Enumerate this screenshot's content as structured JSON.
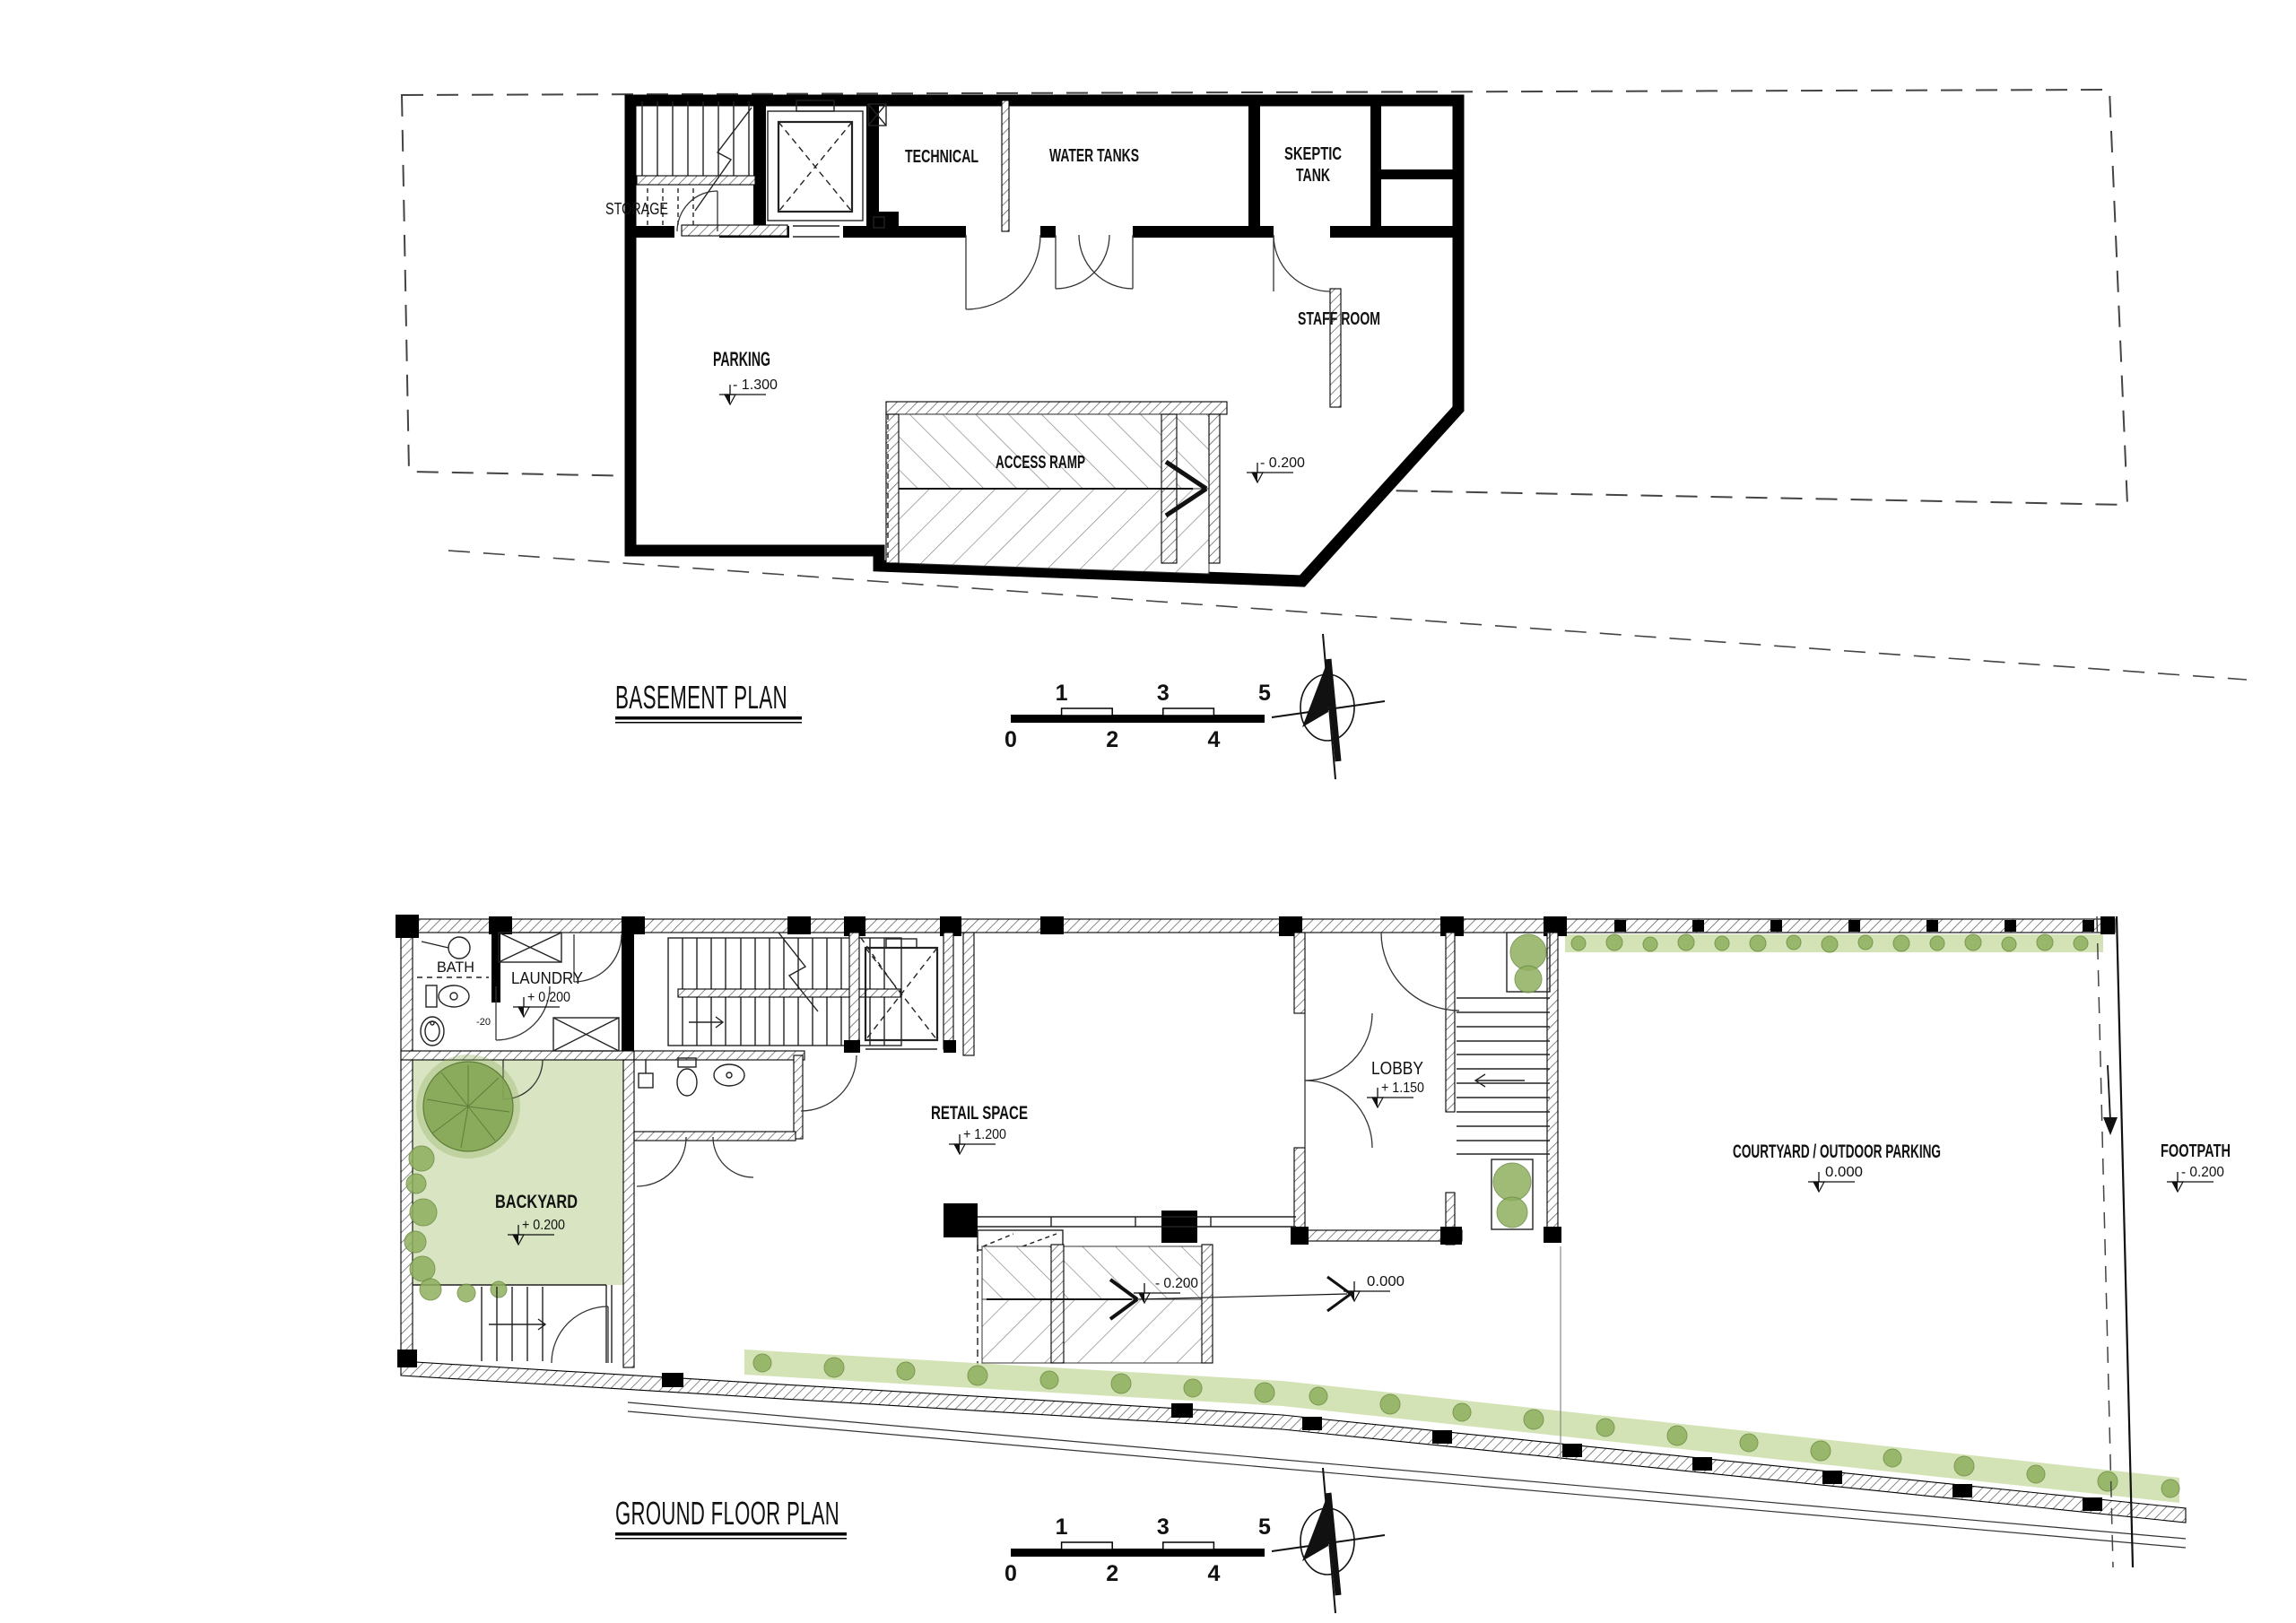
{
  "basement": {
    "title": "BASEMENT PLAN",
    "rooms": {
      "storage": "STORAGE",
      "technical": "TECHNICAL",
      "water_tanks": "WATER TANKS",
      "skeptic_tank_line1": "SKEPTIC",
      "skeptic_tank_line2": "TANK",
      "staff_room": "STAFF ROOM",
      "parking": "PARKING",
      "parking_level": "- 1.300",
      "access_ramp": "ACCESS RAMP",
      "access_ramp_level": "- 0.200"
    }
  },
  "ground": {
    "title": "GROUND FLOOR PLAN",
    "rooms": {
      "bath": "BATH",
      "laundry": "LAUNDRY",
      "laundry_level": "+ 0.200",
      "door_dimension": "-20",
      "backyard": "BACKYARD",
      "backyard_level": "+ 0.200",
      "retail": "RETAIL SPACE",
      "retail_level": "+ 1.200",
      "lobby": "LOBBY",
      "lobby_level": "+ 1.150",
      "courtyard": "COURTYARD / OUTDOOR PARKING",
      "courtyard_level": "0.000",
      "driveway_level_low": "- 0.200",
      "driveway_level_high": "0.000",
      "footpath": "FOOTPATH",
      "footpath_level": "- 0.200"
    }
  },
  "scale_bar": {
    "top_labels": [
      "1",
      "3",
      "5"
    ],
    "bottom_labels": [
      "0",
      "2",
      "4"
    ]
  },
  "colors": {
    "wall": "#000000",
    "hatch_line": "#555555",
    "boundary_dash": "#444444",
    "green_light": "#d9e5c2",
    "green_mid": "#8fb05e",
    "green_dark": "#6a8c42"
  }
}
